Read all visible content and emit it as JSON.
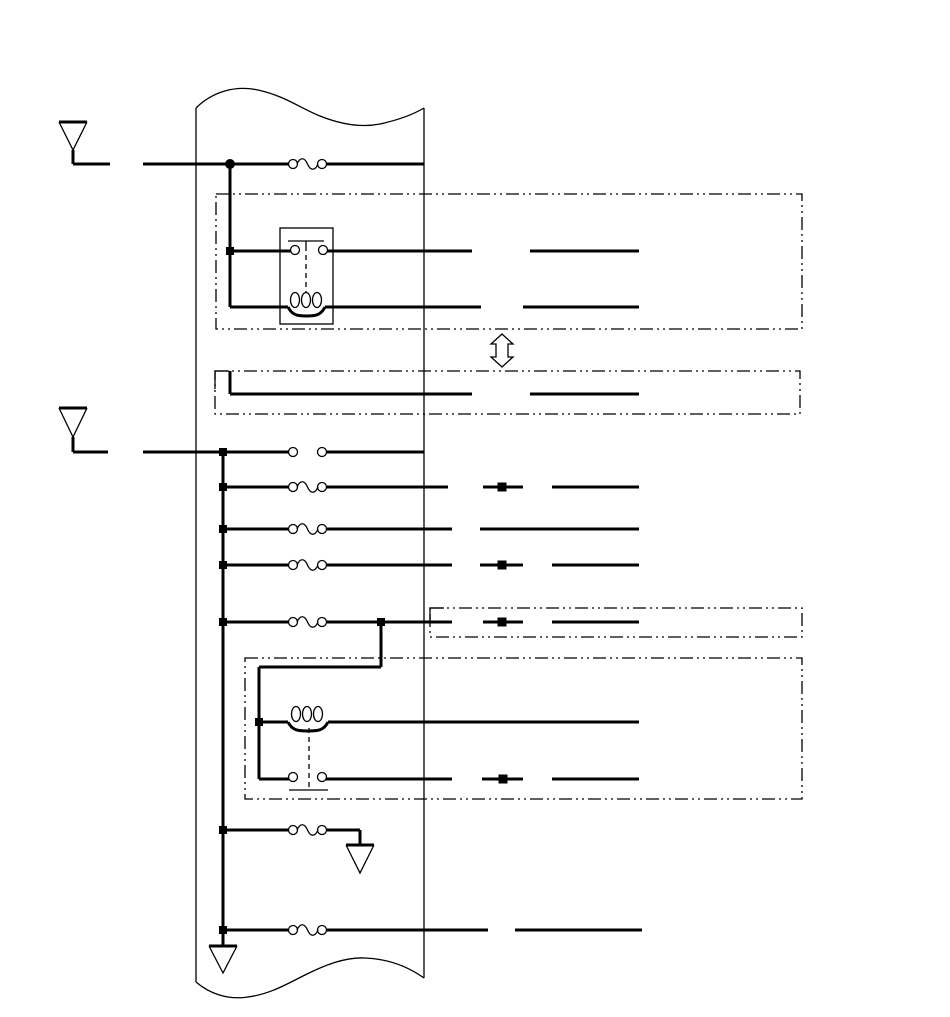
{
  "title": "wiring-harness-schematic",
  "canvas": {
    "width": 950,
    "height": 1017,
    "background": "#ffffff",
    "line_color": "#000000",
    "thick_stroke": 3,
    "thin_stroke": 1.3,
    "enclosure_dash": "13 4 2 4 2 4",
    "link_dash": "5 4"
  },
  "harness": {
    "left_rail": {
      "x": 196,
      "y1": 108,
      "y2": 982
    },
    "right_rail": {
      "x": 424,
      "y1": 108,
      "y2": 978
    },
    "top_wave": "M196,108 C212,92 235,85 258,90 C285,96 300,108 320,116 C340,124 360,128 380,124 C398,120 414,114 424,108",
    "bottom_wave": "M196,982 C210,994 228,1000 248,997 C270,994 285,985 305,975 C325,965 345,957 365,958 C390,959 410,968 424,978"
  },
  "antennas": [
    {
      "name": "antenna-top",
      "cx": 73,
      "bar_y": 122,
      "apex_y": 150,
      "bar_half": 14,
      "stem_bottom": 164,
      "lead_x2": 110
    },
    {
      "name": "antenna-middle",
      "cx": 73,
      "bar_y": 408,
      "apex_y": 437,
      "bar_half": 14,
      "stem_bottom": 452,
      "lead_x2": 108
    }
  ],
  "grounds": [
    {
      "name": "ground-branch",
      "cx": 360,
      "bar_y": 845,
      "apex_y": 873,
      "bar_half": 14
    },
    {
      "name": "ground-main",
      "cx": 223,
      "bar_y": 946,
      "apex_y": 973,
      "bar_half": 14
    }
  ],
  "wires": [
    [
      73,
      164,
      110,
      164
    ],
    [
      143,
      164,
      288,
      164
    ],
    [
      327,
      164,
      424,
      164
    ],
    [
      230,
      164,
      230,
      307
    ],
    [
      230,
      251,
      291,
      251
    ],
    [
      327,
      251,
      472,
      251
    ],
    [
      530,
      251,
      639,
      251
    ],
    [
      230,
      307,
      288,
      307
    ],
    [
      325,
      307,
      481,
      307
    ],
    [
      523,
      307,
      639,
      307
    ],
    [
      230,
      371,
      230,
      394
    ],
    [
      230,
      394,
      472,
      394
    ],
    [
      530,
      394,
      639,
      394
    ],
    [
      73,
      452,
      108,
      452
    ],
    [
      143,
      452,
      288,
      452
    ],
    [
      327,
      452,
      424,
      452
    ],
    [
      223,
      452,
      223,
      946
    ],
    [
      223,
      487,
      288,
      487
    ],
    [
      327,
      487,
      448,
      487
    ],
    [
      483,
      487,
      523,
      487
    ],
    [
      552,
      487,
      639,
      487
    ],
    [
      223,
      529,
      288,
      529
    ],
    [
      327,
      529,
      452,
      529
    ],
    [
      480,
      529,
      639,
      529
    ],
    [
      223,
      565,
      288,
      565
    ],
    [
      327,
      565,
      452,
      565
    ],
    [
      480,
      565,
      523,
      565
    ],
    [
      552,
      565,
      639,
      565
    ],
    [
      223,
      622,
      288,
      622
    ],
    [
      327,
      622,
      452,
      622
    ],
    [
      483,
      622,
      523,
      622
    ],
    [
      552,
      622,
      639,
      622
    ],
    [
      381,
      622,
      381,
      667
    ],
    [
      381,
      667,
      259,
      667
    ],
    [
      259,
      667,
      259,
      779
    ],
    [
      259,
      722,
      288,
      722
    ],
    [
      328,
      722,
      639,
      722
    ],
    [
      259,
      779,
      289,
      779
    ],
    [
      326,
      779,
      452,
      779
    ],
    [
      482,
      779,
      523,
      779
    ],
    [
      552,
      779,
      639,
      779
    ],
    [
      223,
      830,
      288,
      830
    ],
    [
      327,
      830,
      360,
      830
    ],
    [
      360,
      830,
      360,
      845
    ],
    [
      223,
      930,
      288,
      930
    ],
    [
      327,
      930,
      488,
      930
    ],
    [
      515,
      930,
      642,
      930
    ]
  ],
  "fuses": [
    {
      "x": 293,
      "y": 164
    },
    {
      "x": 293,
      "y": 487
    },
    {
      "x": 293,
      "y": 529
    },
    {
      "x": 293,
      "y": 565
    },
    {
      "x": 293,
      "y": 622
    },
    {
      "x": 293,
      "y": 830
    },
    {
      "x": 293,
      "y": 930
    }
  ],
  "open_pairs": [
    {
      "x": 293,
      "y": 452
    }
  ],
  "relay_box": {
    "x": 280,
    "y": 228,
    "w": 53,
    "h": 96
  },
  "relay_bars": [
    {
      "x1": 288,
      "y": 241,
      "x2": 324
    },
    {
      "x1": 289,
      "y": 790,
      "x2": 328
    }
  ],
  "bar_stub": {
    "x": 306,
    "y1": 241,
    "y2": 246
  },
  "contact_hooks": [
    {
      "x": 295,
      "y": 250
    },
    {
      "x": 323,
      "y": 250
    },
    {
      "x": 293,
      "y": 777
    },
    {
      "x": 322,
      "y": 777
    }
  ],
  "dashed_links": [
    {
      "x": 306,
      "y1": 246,
      "y2": 298
    },
    {
      "x": 309,
      "y1": 728,
      "y2": 787
    }
  ],
  "coils": [
    {
      "x1": 288,
      "x2": 325,
      "y": 307,
      "loop_cy": 300,
      "centers": [
        295,
        306,
        317
      ],
      "rx": 4.5,
      "ry": 7.5
    },
    {
      "x1": 288,
      "x2": 328,
      "y": 722,
      "loop_cy": 714,
      "centers": [
        296,
        307,
        318
      ],
      "rx": 4.5,
      "ry": 7.5
    }
  ],
  "dashed_boxes": [
    {
      "x": 216,
      "y": 194,
      "w": 586,
      "h": 135
    },
    {
      "x": 215,
      "y": 371,
      "w": 585,
      "h": 43
    },
    {
      "x": 430,
      "y": 608,
      "w": 372,
      "h": 29
    },
    {
      "x": 245,
      "y": 658,
      "w": 557,
      "h": 141
    }
  ],
  "corner_pieces": [
    {
      "pts": [
        215,
        389,
        215,
        371,
        229,
        371
      ]
    },
    {
      "pts": [
        430,
        622,
        430,
        608,
        444,
        608
      ]
    }
  ],
  "junction_squares": [
    [
      230,
      251
    ],
    [
      223,
      452
    ],
    [
      223,
      487
    ],
    [
      223,
      529
    ],
    [
      223,
      565
    ],
    [
      223,
      622
    ],
    [
      381,
      622
    ],
    [
      259,
      722
    ],
    [
      223,
      830
    ],
    [
      223,
      930
    ]
  ],
  "mid_squares": [
    [
      502,
      487
    ],
    [
      502,
      565
    ],
    [
      502,
      622
    ],
    [
      503,
      779
    ]
  ],
  "junction_dots": [
    [
      230,
      164
    ]
  ],
  "double_arrow": {
    "cx": 502,
    "top": 334,
    "bottom": 367,
    "head_half": 11,
    "shaft_half": 6,
    "head_h": 10
  }
}
